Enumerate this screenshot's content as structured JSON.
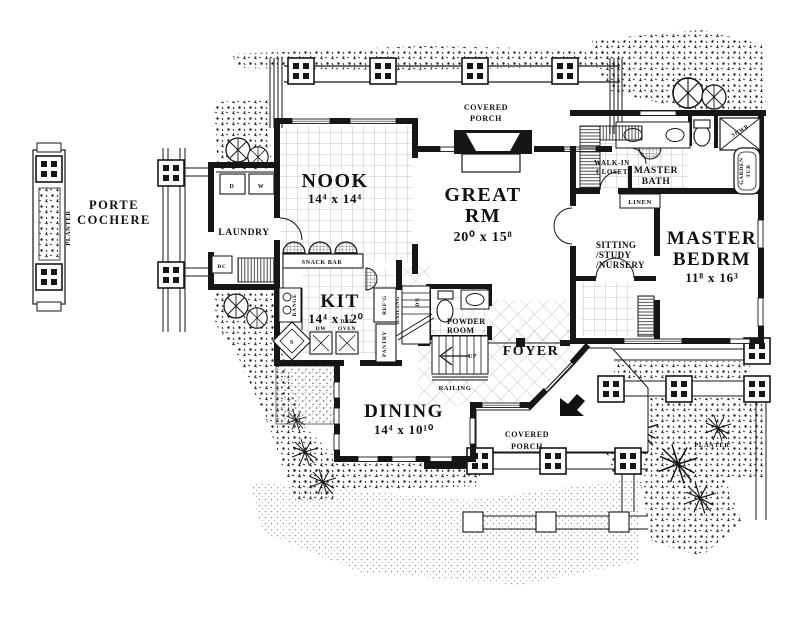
{
  "drawing": {
    "type": "architectural floor plan, main level",
    "ink_color": "#161616",
    "paper_color": "#ffffff"
  },
  "exterior": {
    "porte_cochere": {
      "line1": "PORTE",
      "line2": "COCHERE"
    },
    "planter_left": "PLANTER",
    "planter_right": "PLANTER",
    "covered_porch_top": {
      "line1": "COVERED",
      "line2": "PORCH"
    },
    "covered_porch_bottom": {
      "line1": "COVERED",
      "line2": "PORCH"
    }
  },
  "rooms": {
    "nook": {
      "name": "NOOK",
      "dims": "14⁴ x 14⁴"
    },
    "great_room": {
      "line1": "GREAT",
      "line2": "RM",
      "dims": "20⁰ x 15⁸"
    },
    "kitchen": {
      "name": "KIT",
      "dims": "14⁴ x 12⁰"
    },
    "dining": {
      "name": "DINING",
      "dims": "14⁴ x 10¹⁰"
    },
    "master_bedroom": {
      "line1": "MASTER",
      "line2": "BEDRM",
      "dims": "11⁸ x 16³"
    },
    "sitting": {
      "line1": "SITTING",
      "line2": "/STUDY",
      "line3": "/NURSERY"
    },
    "master_bath": {
      "line1": "MASTER",
      "line2": "BATH"
    },
    "walk_in_closet": {
      "line1": "WALK-IN",
      "line2": "CLOSET"
    },
    "laundry": {
      "name": "LAUNDRY"
    },
    "powder_room": {
      "line1": "POWDER",
      "line2": "ROOM"
    },
    "foyer": {
      "name": "FOYER"
    }
  },
  "fixtures": {
    "snack_bar": "SNACK BAR",
    "range": "RANGE",
    "refrigerator": "REF'G",
    "pantry": "PANTRY",
    "dishwasher": "DW",
    "double_oven_line1": "DBL",
    "double_oven_line2": "OVEN",
    "sink": "S",
    "dryer": "D",
    "washer": "W",
    "broom_closet": "BC",
    "linen": "LINEN",
    "shower": "SHWR",
    "garden_tub_line1": "GARDEN",
    "garden_tub_line2": "TUB"
  },
  "stairs": {
    "up": "UP",
    "dn": "DN",
    "railing_vertical": "RAILING",
    "railing_lower": "RAILING"
  }
}
